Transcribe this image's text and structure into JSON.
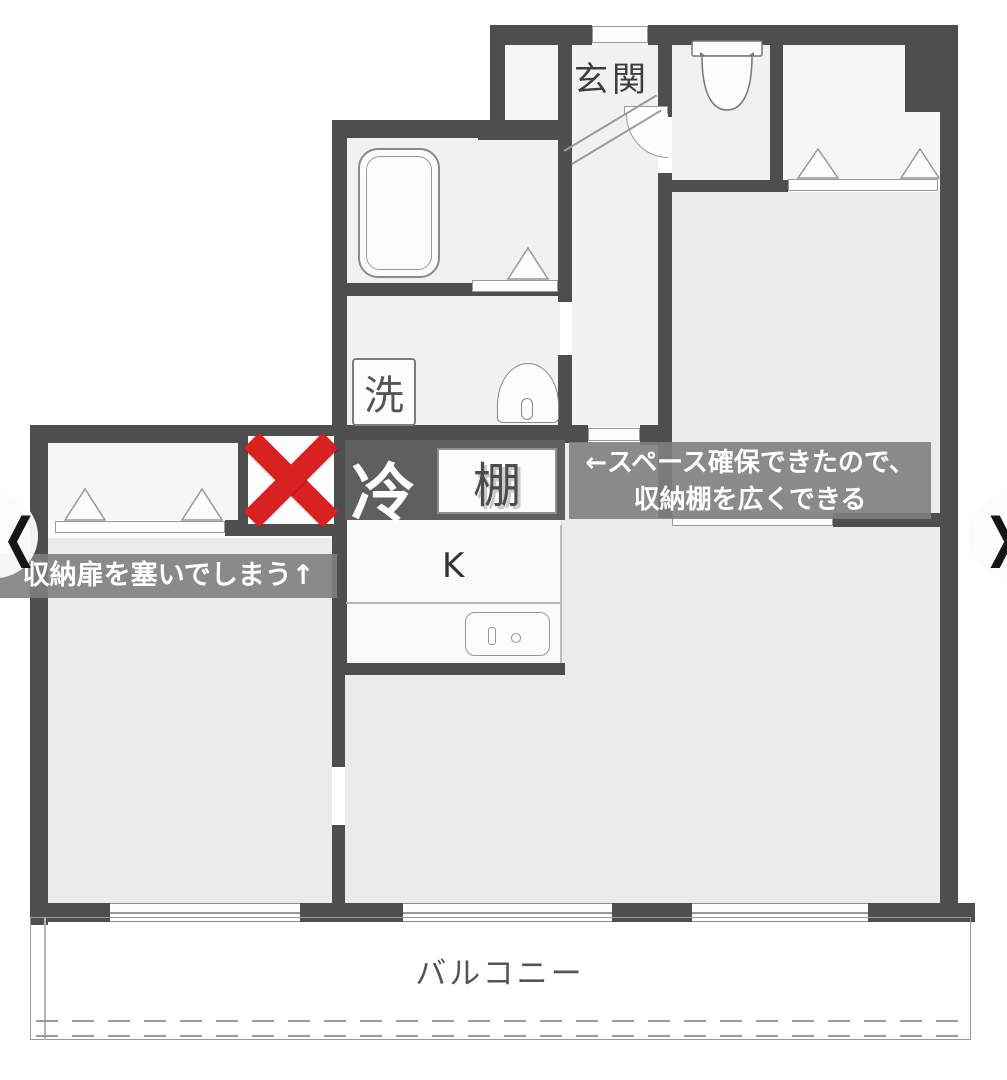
{
  "plan": {
    "room_labels": {
      "genkan": "玄関",
      "washer": "洗",
      "fridge": "冷",
      "shelf": "棚",
      "kitchen": "K",
      "balcony": "バルコニー"
    },
    "annotations": {
      "left_note": "収納扉を塞いでしまう↑",
      "right_note_line1": "←スペース確保できたので、",
      "right_note_line2": "収納棚を広くできる"
    },
    "icons": {
      "x_mark": "x-mark-icon",
      "bathtub": "bathtub-icon",
      "toilet": "toilet-icon",
      "sink": "sink-icon",
      "kitchen_sink": "kitchen-sink-icon"
    },
    "colors": {
      "wall": "#4e4e4e",
      "room_floor": "#ebebec",
      "service_floor": "#f1f1f2",
      "fridge_box_bg": "#5f5f5f",
      "x_mark": "#d92121",
      "annotation_bg": "rgba(128,128,128,0.9)"
    }
  },
  "carousel": {
    "prev_label": "❮",
    "next_label": "❯"
  }
}
